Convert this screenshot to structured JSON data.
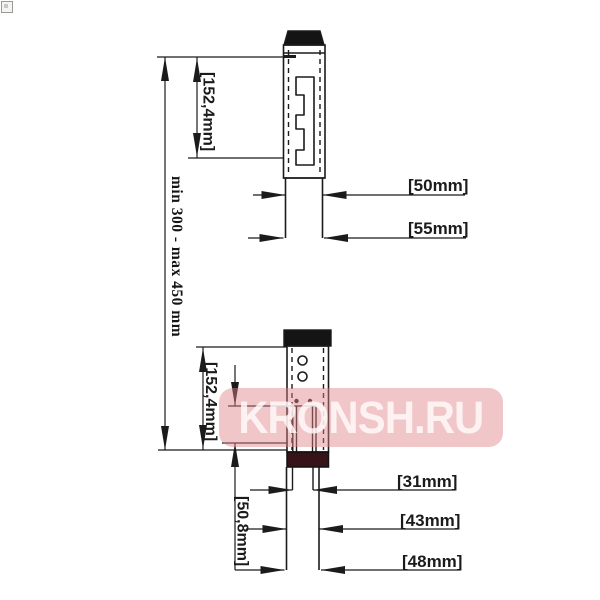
{
  "watermark": {
    "text": "KRONSH.RU"
  },
  "dimensions": {
    "overall_range": "min 300 - max 450 mm",
    "upper_slot_length": "[152,4mm]",
    "upper_tube_diameter": "[50mm]",
    "upper_tube_outer_diameter": "[55mm]",
    "lower_slot_length": "[152,4mm]",
    "lower_insert_depth": "[50,8mm]",
    "lower_inner_tube_diameter": "[31mm]",
    "lower_tube_diameter": "[43mm]",
    "lower_adapter_diameter": "[48mm]"
  },
  "colors": {
    "line": "#1b1b1b",
    "cap_fill": "#141414",
    "collar_band_fill": "#371219",
    "watermark_background": "#de828a",
    "watermark_text": "#fffafa"
  }
}
